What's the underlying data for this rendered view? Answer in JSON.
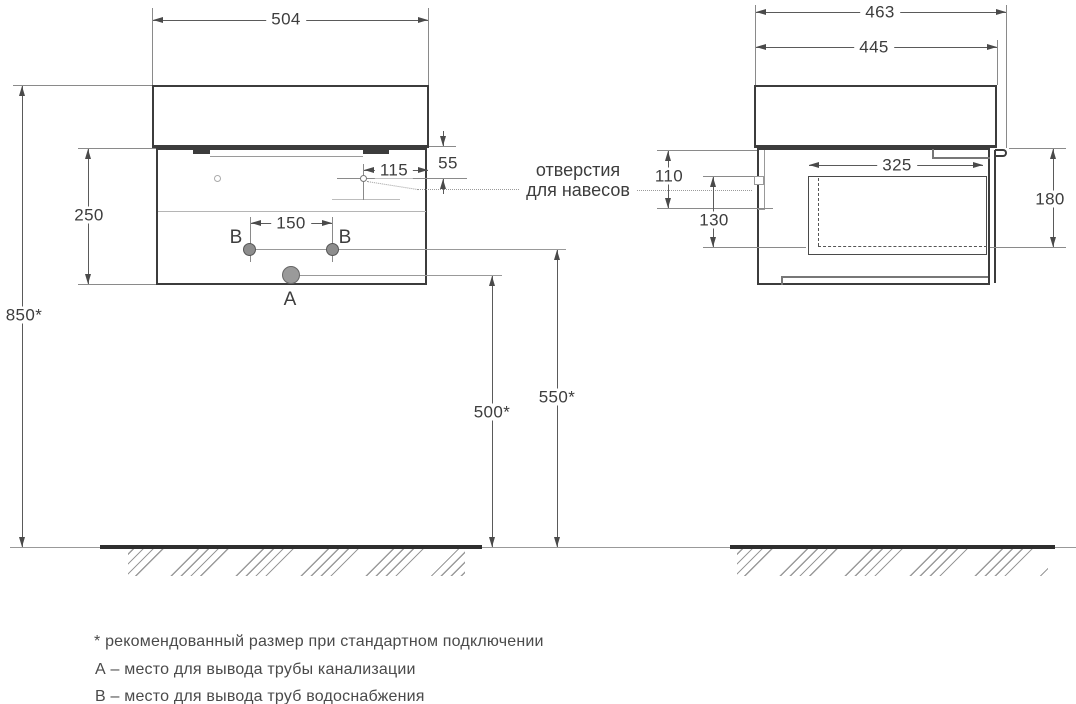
{
  "drawing": {
    "title": "vanity-cabinet-installation-dimensions",
    "front_view": {
      "width": "504",
      "height_overall": "850*",
      "cabinet_height": "250",
      "hanger_offset_h": "115",
      "hanger_offset_v": "55",
      "water_spacing": "150",
      "drain_clearance": "500*",
      "water_clearance": "550*",
      "point_a": "A",
      "point_b_left": "B",
      "point_b_right": "B"
    },
    "side_view": {
      "depth_overall": "463",
      "depth_countertop": "445",
      "inner_depth": "325",
      "hanger_top_offset": "110",
      "hanger_bottom_offset": "130",
      "drawer_height": "180"
    },
    "callout": {
      "line1": "отверстия",
      "line2": "для навесов"
    },
    "legend": {
      "note_recommended": "* рекомендованный размер при стандартном подключении",
      "note_a": "А – место для вывода трубы канализации",
      "note_b": "В – место для вывода труб водоснабжения"
    },
    "colors": {
      "outline": "#3c3c3c",
      "dimension": "#5a5a5a",
      "text": "#3f3f3f",
      "background": "#ffffff"
    }
  }
}
